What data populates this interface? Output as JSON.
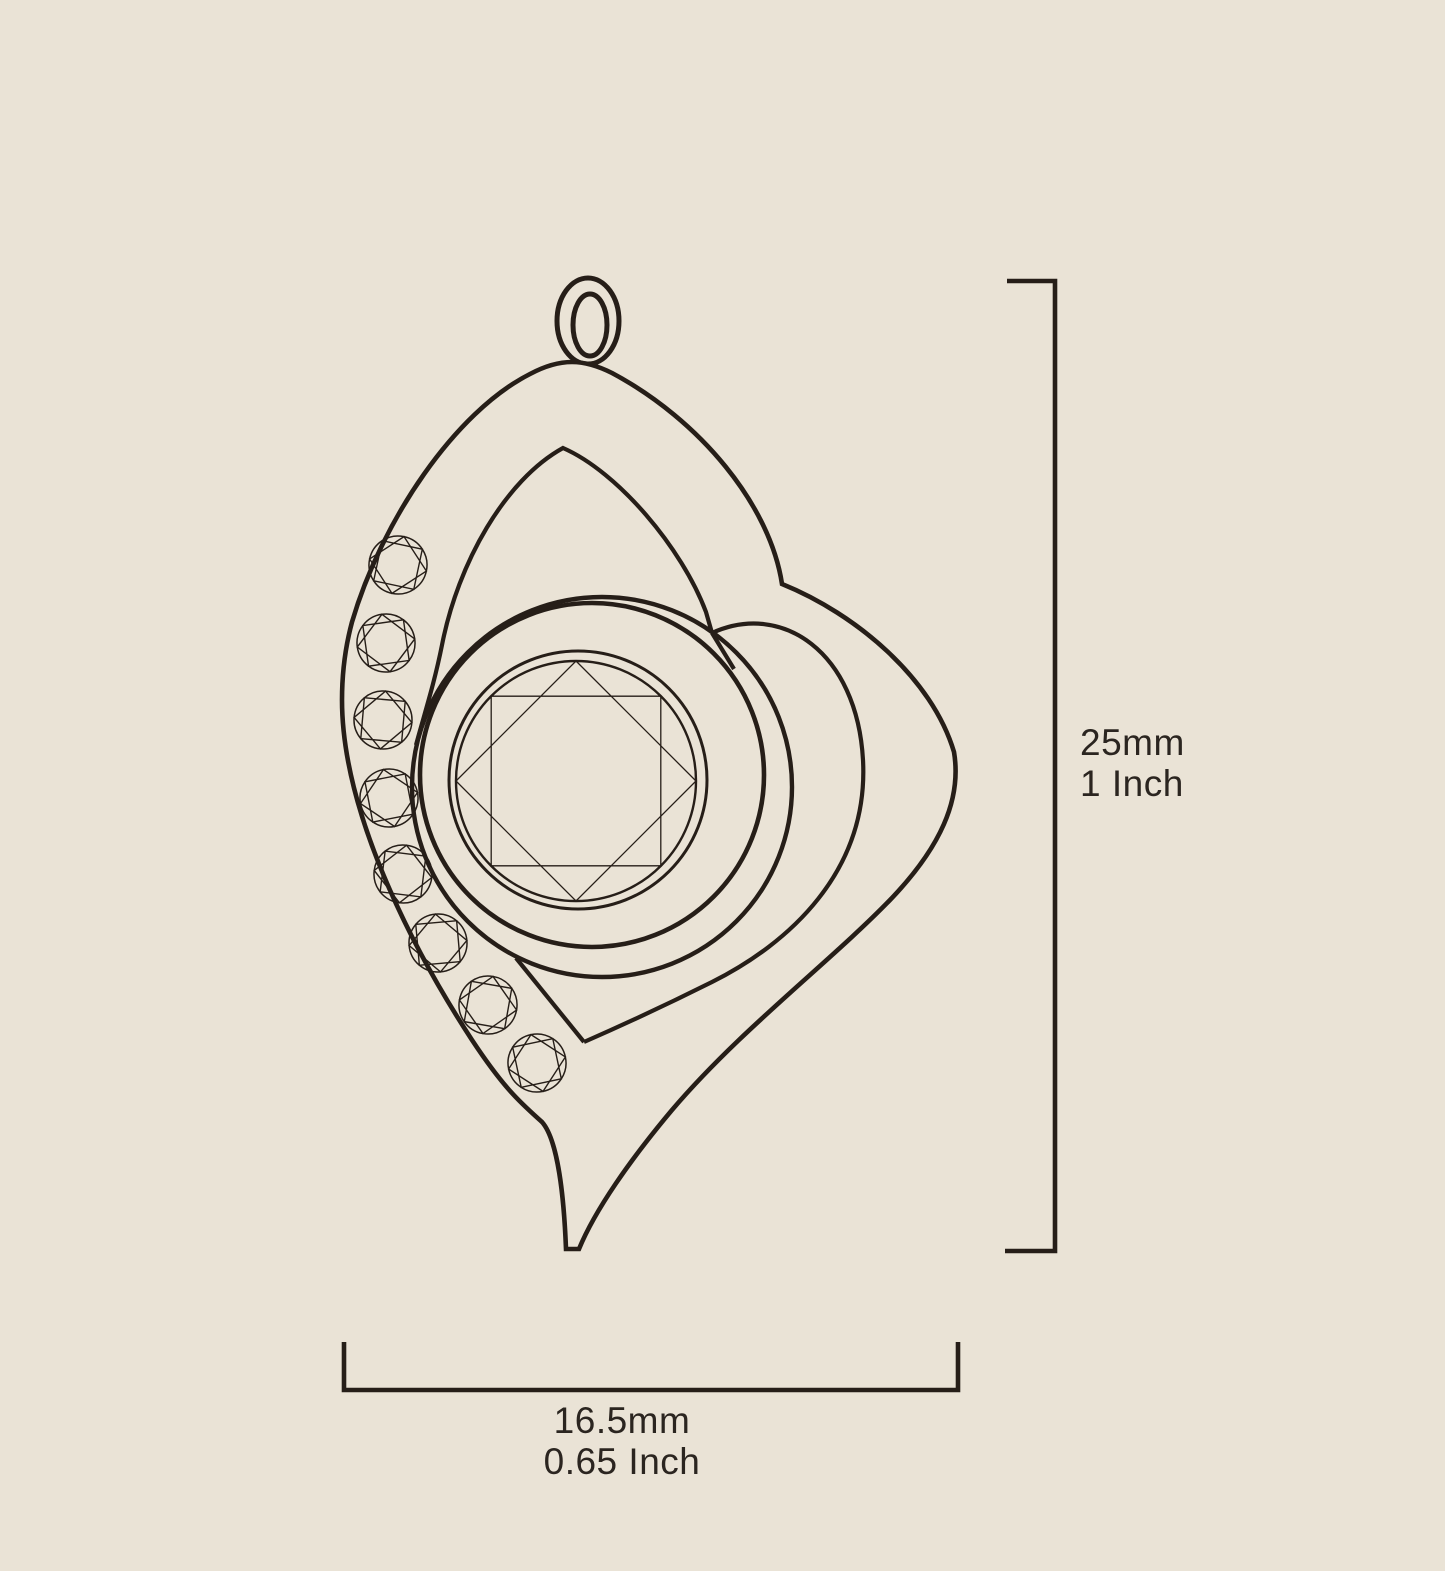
{
  "palette": {
    "background": "#EAE3D6",
    "line": "#261E18",
    "text": "#2B2520"
  },
  "illustration": {
    "subject": "heart-pendant-line-drawing",
    "center_stones": 1,
    "accent_stones": 8,
    "has_bail": true
  },
  "dimensions": {
    "height": {
      "primary": "25mm",
      "secondary": "1 Inch"
    },
    "width": {
      "primary": "16.5mm",
      "secondary": "0.65 Inch"
    }
  }
}
